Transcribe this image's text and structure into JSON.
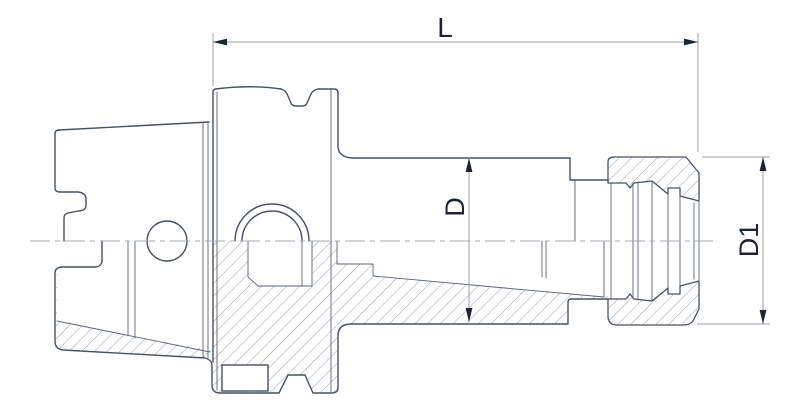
{
  "diagram": {
    "type": "technical-drawing",
    "subject": "HSK collet chuck tool holder",
    "view": "side elevation, lower half shown in cross-section with hatching",
    "labels": {
      "length": "L",
      "body_diameter": "D",
      "nut_diameter": "D1"
    },
    "colors": {
      "background": "#ffffff",
      "line": "#47515f",
      "thin_line": "#5a6472",
      "hatch": "#7d8794",
      "dim_line": "#9aa1a9",
      "text": "#1c2430",
      "centerline": "#a4aab2"
    }
  }
}
